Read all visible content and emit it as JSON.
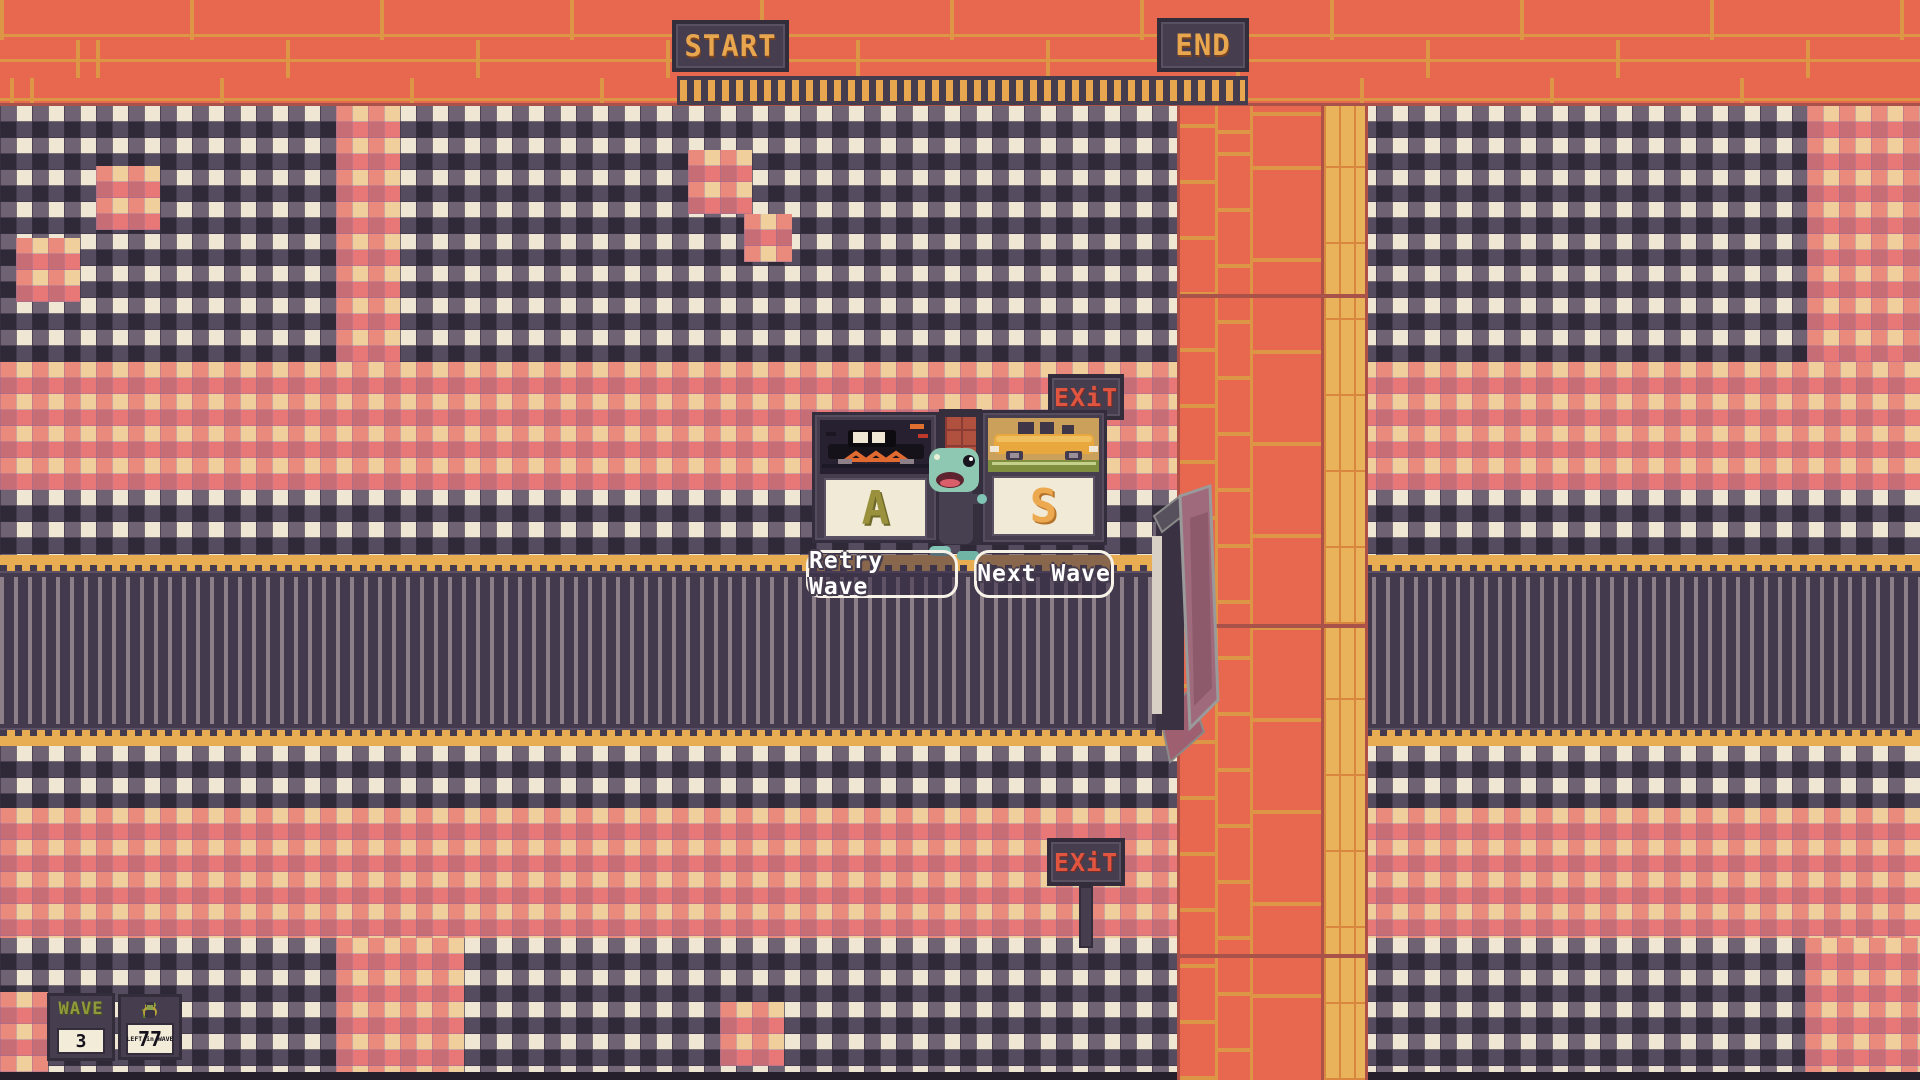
{
  "signs": {
    "start": "START",
    "end": "END",
    "exit_upper": "EXiT",
    "exit_lower": "EXiT"
  },
  "action_cards": [
    {
      "hotkey": "A",
      "vehicle": "black-limo-card"
    },
    {
      "hotkey": "S",
      "vehicle": "yellow-car-card"
    }
  ],
  "wave_buttons": {
    "retry": "Retry Wave",
    "next": "Next Wave"
  },
  "hud": {
    "wave_label": "WAVE",
    "wave_number": "3",
    "remaining_number": "77",
    "remaining_label": "LEFT in WAVE"
  },
  "palette": {
    "brick_orange": "#e8674f",
    "mortar_gold": "#dd9546",
    "road_dark": "#433a4d",
    "road_stripe": "#8d7f88",
    "border_gold": "#e8ac52",
    "panel_dark": "#463d4f",
    "cream": "#f2ecd8",
    "exit_red": "#e05540",
    "letter_a": "#99913c",
    "letter_s": "#eda94f",
    "hud_wave_green": "#8f9a3a"
  }
}
